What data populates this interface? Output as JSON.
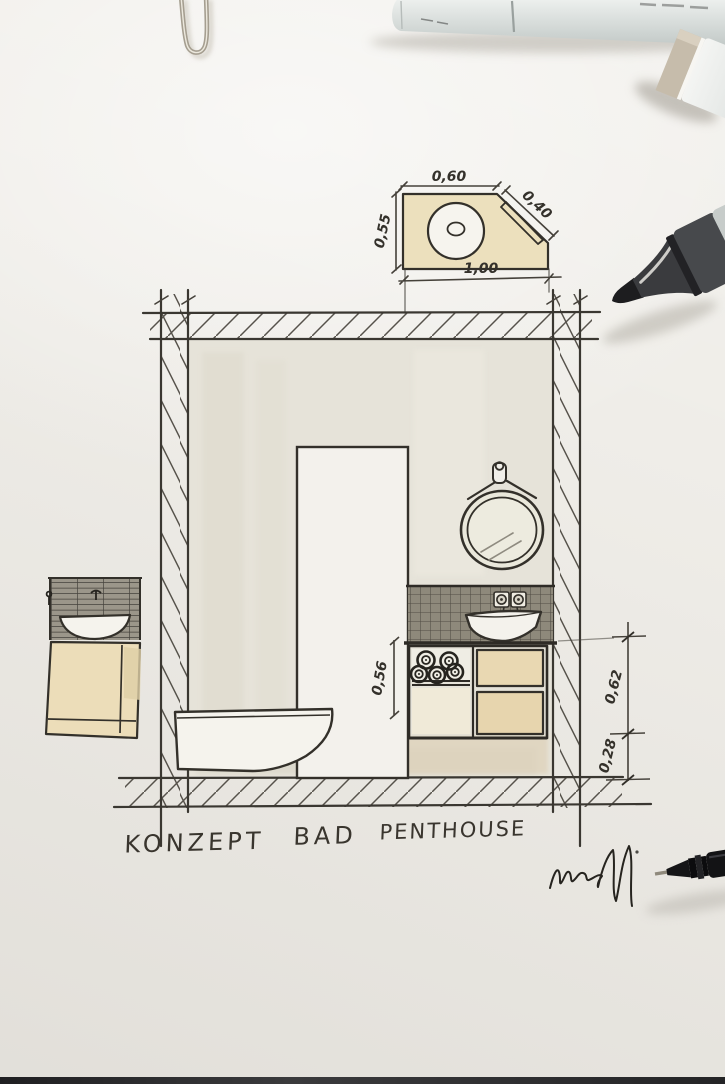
{
  "caption": {
    "full": "KONZEPT BAD PENTHOUSE",
    "w1": "KONZEPT",
    "w2": "BAD",
    "w3": "PENTHOUSE"
  },
  "dims": {
    "detail_top": "0,60",
    "detail_left": "0,55",
    "detail_diag": "0,40",
    "detail_bottom": "1,00",
    "niche": "0,56",
    "vanity_upper": "0,62",
    "vanity_lower": "0,28"
  },
  "objects": {
    "paperclip": "metal paperclip end",
    "gray_marker": "gray Copic-style marker lying across top",
    "angled_marker": "white marker with greige cap, top right corner",
    "black_marker": "dark gray marker, tip pointing left",
    "fineliner": "black fineliner pen, tip pointing left",
    "signature": "hand signature scribble"
  },
  "colors": {
    "paper": "#efede8",
    "ink": "#33302a",
    "pencil": "#4a463f",
    "beige_marker_wash": "#e9d8b2",
    "tile_wash": "#8e897b",
    "interior_wash": "#e6e3d9"
  }
}
